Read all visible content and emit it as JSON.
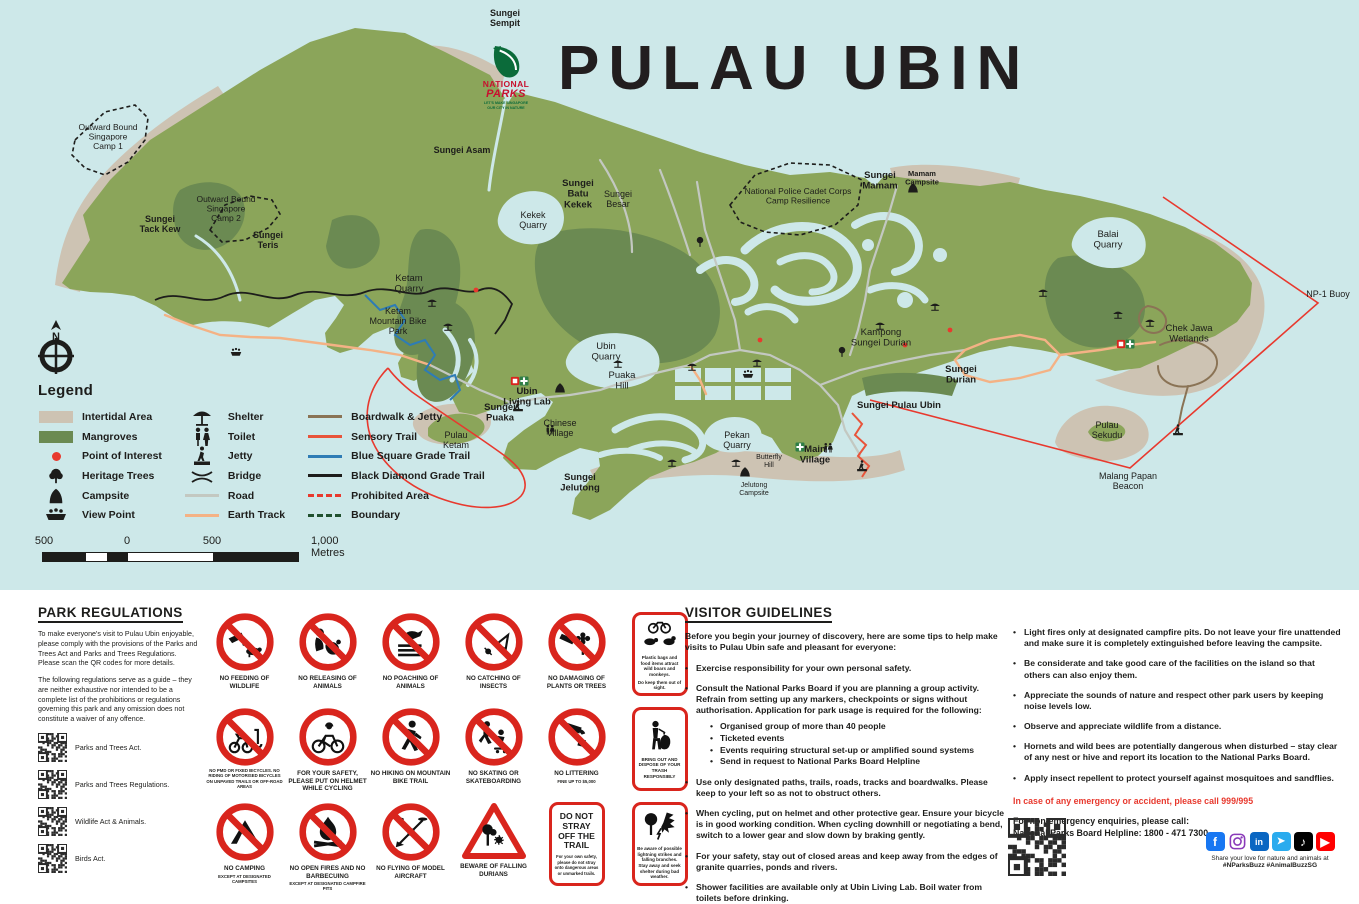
{
  "title": "PULAU UBIN",
  "logo": {
    "line1": "NATIONAL",
    "line2": "PARKS",
    "tagline1": "LET'S MAKE SINGAPORE",
    "tagline2": "OUR CITY IN NATURE"
  },
  "colors": {
    "water": "#cde8e9",
    "land": "#8ba55a",
    "mangrove": "#6b8a52",
    "intertidal": "#cdc3b3",
    "road": "#c3c8c1",
    "earth_track": "#f4b285",
    "boardwalk": "#8a7355",
    "blue_trail": "#2e7cb5",
    "red": "#e8392e",
    "sign_red": "#d9251d",
    "text": "#1d1d1b"
  },
  "map": {
    "compass_label": "N",
    "labels": [
      {
        "lines": [
          "Sungei",
          "Sempit"
        ],
        "x": 505,
        "y": 16,
        "bold": true,
        "size": 9
      },
      {
        "lines": [
          "Outward Bound",
          "Singapore",
          "Camp 1"
        ],
        "x": 108,
        "y": 130,
        "bold": false,
        "size": 8.5
      },
      {
        "lines": [
          "Outward Bound",
          "Singapore",
          "Camp 2"
        ],
        "x": 226,
        "y": 202,
        "bold": false,
        "size": 8.5
      },
      {
        "lines": [
          "Sungei",
          "Tack Kew"
        ],
        "x": 160,
        "y": 222,
        "bold": true,
        "size": 9
      },
      {
        "lines": [
          "Sungei",
          "Teris"
        ],
        "x": 268,
        "y": 238,
        "bold": true,
        "size": 9
      },
      {
        "lines": [
          "Sungei Asam"
        ],
        "x": 462,
        "y": 153,
        "bold": true,
        "size": 9
      },
      {
        "lines": [
          "Sungei",
          "Batu",
          "Kekek"
        ],
        "x": 578,
        "y": 186,
        "bold": true,
        "size": 9.5
      },
      {
        "lines": [
          "Sungei",
          "Besar"
        ],
        "x": 618,
        "y": 197,
        "bold": false,
        "size": 9
      },
      {
        "lines": [
          "Kekek",
          "Quarry"
        ],
        "x": 533,
        "y": 218,
        "bold": false,
        "size": 9
      },
      {
        "lines": [
          "Ketam",
          "Quarry"
        ],
        "x": 409,
        "y": 281,
        "bold": false,
        "size": 9.5
      },
      {
        "lines": [
          "Ketam",
          "Mountain Bike",
          "Park"
        ],
        "x": 398,
        "y": 314,
        "bold": false,
        "size": 9
      },
      {
        "lines": [
          "Ubin",
          "Quarry"
        ],
        "x": 606,
        "y": 349,
        "bold": false,
        "size": 9.5
      },
      {
        "lines": [
          "Puaka",
          "Hill"
        ],
        "x": 622,
        "y": 378,
        "bold": false,
        "size": 9.5
      },
      {
        "lines": [
          "Ubin",
          "Living Lab"
        ],
        "x": 527,
        "y": 394,
        "bold": true,
        "size": 9.5
      },
      {
        "lines": [
          "Sungei",
          "Puaka"
        ],
        "x": 500,
        "y": 410,
        "bold": true,
        "size": 9.5
      },
      {
        "lines": [
          "Chinese",
          "Village"
        ],
        "x": 560,
        "y": 426,
        "bold": false,
        "size": 9
      },
      {
        "lines": [
          "Pulau",
          "Ketam"
        ],
        "x": 456,
        "y": 438,
        "bold": false,
        "size": 9
      },
      {
        "lines": [
          "Sungei",
          "Jelutong"
        ],
        "x": 580,
        "y": 480,
        "bold": true,
        "size": 9.5
      },
      {
        "lines": [
          "Pekan",
          "Quarry"
        ],
        "x": 737,
        "y": 438,
        "bold": false,
        "size": 9
      },
      {
        "lines": [
          "Butterfly",
          "Hill"
        ],
        "x": 769,
        "y": 459,
        "bold": false,
        "size": 7
      },
      {
        "lines": [
          "Main",
          "Village"
        ],
        "x": 815,
        "y": 452,
        "bold": true,
        "size": 9.5
      },
      {
        "lines": [
          "Jelutong",
          "Campsite"
        ],
        "x": 754,
        "y": 487,
        "bold": false,
        "size": 7
      },
      {
        "lines": [
          "Sungei",
          "Mamam"
        ],
        "x": 880,
        "y": 178,
        "bold": true,
        "size": 9.5
      },
      {
        "lines": [
          "Mamam",
          "Campsite"
        ],
        "x": 922,
        "y": 176,
        "bold": true,
        "size": 7.5
      },
      {
        "lines": [
          "National Police Cadet Corps",
          "Camp Resilience"
        ],
        "x": 798,
        "y": 194,
        "bold": false,
        "size": 8.5
      },
      {
        "lines": [
          "Kampong",
          "Sungei Durian"
        ],
        "x": 881,
        "y": 335,
        "bold": false,
        "size": 9.5
      },
      {
        "lines": [
          "Sungei",
          "Durian"
        ],
        "x": 961,
        "y": 372,
        "bold": true,
        "size": 9.5
      },
      {
        "lines": [
          "Sungei Pulau Ubin"
        ],
        "x": 899,
        "y": 408,
        "bold": true,
        "size": 9.5
      },
      {
        "lines": [
          "Balai",
          "Quarry"
        ],
        "x": 1108,
        "y": 237,
        "bold": false,
        "size": 9.5
      },
      {
        "lines": [
          "Chek Jawa",
          "Wetlands"
        ],
        "x": 1189,
        "y": 331,
        "bold": false,
        "size": 9.5
      },
      {
        "lines": [
          "NP-1 Buoy"
        ],
        "x": 1328,
        "y": 297,
        "bold": false,
        "size": 9
      },
      {
        "lines": [
          "Pulau",
          "Sekudu"
        ],
        "x": 1107,
        "y": 428,
        "bold": false,
        "size": 9
      },
      {
        "lines": [
          "Malang Papan",
          "Beacon"
        ],
        "x": 1128,
        "y": 479,
        "bold": false,
        "size": 9
      }
    ],
    "icons": [
      {
        "icon": "shelter-icon",
        "x": 432,
        "y": 302
      },
      {
        "icon": "shelter-icon",
        "x": 448,
        "y": 326
      },
      {
        "icon": "shelter-icon",
        "x": 618,
        "y": 363
      },
      {
        "icon": "shelter-icon",
        "x": 692,
        "y": 366
      },
      {
        "icon": "shelter-icon",
        "x": 757,
        "y": 362
      },
      {
        "icon": "shelter-icon",
        "x": 880,
        "y": 325
      },
      {
        "icon": "shelter-icon",
        "x": 935,
        "y": 306
      },
      {
        "icon": "shelter-icon",
        "x": 1043,
        "y": 292
      },
      {
        "icon": "shelter-icon",
        "x": 1118,
        "y": 314
      },
      {
        "icon": "shelter-icon",
        "x": 1150,
        "y": 322
      },
      {
        "icon": "shelter-icon",
        "x": 736,
        "y": 462
      },
      {
        "icon": "shelter-icon",
        "x": 672,
        "y": 462
      },
      {
        "icon": "toilet-icon",
        "x": 550,
        "y": 430
      },
      {
        "icon": "toilet-icon",
        "x": 828,
        "y": 448
      },
      {
        "icon": "jetty-icon",
        "x": 862,
        "y": 466
      },
      {
        "icon": "jetty-icon",
        "x": 1178,
        "y": 430
      },
      {
        "icon": "jetty-icon",
        "x": 518,
        "y": 406
      },
      {
        "icon": "green-cross-icon",
        "x": 524,
        "y": 381
      },
      {
        "icon": "green-cross-icon",
        "x": 800,
        "y": 447
      },
      {
        "icon": "green-cross-icon",
        "x": 1130,
        "y": 344
      },
      {
        "icon": "red-square-icon",
        "x": 515,
        "y": 381
      },
      {
        "icon": "red-square-icon",
        "x": 1121,
        "y": 344
      },
      {
        "icon": "viewpoint-icon",
        "x": 236,
        "y": 352
      },
      {
        "icon": "viewpoint-icon",
        "x": 748,
        "y": 374
      },
      {
        "icon": "campsite-icon",
        "x": 560,
        "y": 388
      },
      {
        "icon": "campsite-icon",
        "x": 913,
        "y": 188
      },
      {
        "icon": "campsite-icon",
        "x": 745,
        "y": 472
      },
      {
        "icon": "tree-icon",
        "x": 842,
        "y": 352
      },
      {
        "icon": "tree-icon",
        "x": 700,
        "y": 242
      },
      {
        "icon": "poi-dot",
        "x": 760,
        "y": 340
      },
      {
        "icon": "poi-dot",
        "x": 950,
        "y": 330
      },
      {
        "icon": "poi-dot",
        "x": 905,
        "y": 345
      },
      {
        "icon": "poi-dot",
        "x": 476,
        "y": 290
      }
    ]
  },
  "legend": {
    "title": "Legend",
    "columns": [
      [
        {
          "label": "Intertidal Area",
          "kind": "block",
          "color": "#cdc3b3",
          "name": "intertidal-swatch"
        },
        {
          "label": "Mangroves",
          "kind": "block",
          "color": "#6b8a52",
          "name": "mangroves-swatch"
        },
        {
          "label": "Point of Interest",
          "kind": "dot",
          "color": "#e8392e",
          "name": "point-of-interest-icon"
        },
        {
          "label": "Heritage Trees",
          "kind": "icon",
          "icon": "tree",
          "name": "heritage-tree-icon"
        },
        {
          "label": "Campsite",
          "kind": "icon",
          "icon": "campsite",
          "name": "campsite-icon"
        },
        {
          "label": "View Point",
          "kind": "icon",
          "icon": "viewpoint",
          "name": "viewpoint-icon"
        }
      ],
      [
        {
          "label": "Shelter",
          "kind": "icon",
          "icon": "shelter",
          "name": "shelter-icon"
        },
        {
          "label": "Toilet",
          "kind": "icon",
          "icon": "toilet",
          "name": "toilet-icon"
        },
        {
          "label": "Jetty",
          "kind": "icon",
          "icon": "jetty",
          "name": "jetty-icon"
        },
        {
          "label": "Bridge",
          "kind": "icon",
          "icon": "bridge",
          "name": "bridge-icon"
        },
        {
          "label": "Road",
          "kind": "line",
          "color": "#c3c8c1",
          "dash": "",
          "name": "road-line"
        },
        {
          "label": "Earth Track",
          "kind": "line",
          "color": "#f4b285",
          "dash": "",
          "name": "earth-track-line"
        }
      ],
      [
        {
          "label": "Boardwalk & Jetty",
          "kind": "line",
          "color": "#8a7355",
          "dash": "",
          "name": "boardwalk-line"
        },
        {
          "label": "Sensory Trail",
          "kind": "line",
          "color": "#e8543a",
          "dash": "",
          "name": "sensory-trail-line"
        },
        {
          "label": "Blue Square Grade Trail",
          "kind": "line",
          "color": "#2e7cb5",
          "dash": "",
          "name": "blue-square-trail-line"
        },
        {
          "label": "Black Diamond Grade Trail",
          "kind": "line",
          "color": "#1d1d1b",
          "dash": "",
          "name": "black-diamond-trail-line"
        },
        {
          "label": "Prohibited Area",
          "kind": "line",
          "color": "#e8392e",
          "dash": "dash",
          "name": "prohibited-area-line"
        },
        {
          "label": "Boundary",
          "kind": "line",
          "color": "#20512f",
          "dash": "dash",
          "name": "boundary-line"
        }
      ]
    ]
  },
  "scalebar": {
    "labels": [
      "500",
      "0",
      "500",
      "1,000 Metres"
    ]
  },
  "regulations": {
    "title": "PARK REGULATIONS",
    "para1": "To make everyone's visit to Pulau Ubin enjoyable, please comply with the provisions of the Parks and Trees Act and Parks and Trees Regulations. Please scan the QR codes for more details.",
    "para2": "The following regulations serve as a guide – they are neither exhaustive nor intended to be a complete list of the prohibitions or regulations governing this park and any omission does not constitute a waiver of any offence.",
    "qr_items": [
      "Parks and Trees Act.",
      "Parks and Trees Regulations.",
      "Wildlife Act & Animals.",
      "Birds Act."
    ]
  },
  "signs": {
    "rows": [
      [
        {
          "type": "circle",
          "slash": true,
          "icon": "feeding",
          "name": "no-feeding-of-wildlife-sign",
          "label": "NO FEEDING OF WILDLIFE"
        },
        {
          "type": "circle",
          "slash": true,
          "icon": "release",
          "name": "no-releasing-of-animals-sign",
          "label": "NO RELEASING OF ANIMALS"
        },
        {
          "type": "circle",
          "slash": true,
          "icon": "poach",
          "name": "no-poaching-of-animals-sign",
          "label": "NO POACHING OF ANIMALS"
        },
        {
          "type": "circle",
          "slash": true,
          "icon": "catch",
          "name": "no-catching-of-insects-sign",
          "label": "NO CATCHING OF INSECTS"
        },
        {
          "type": "circle",
          "slash": true,
          "icon": "damage",
          "name": "no-damaging-plants-sign",
          "label": "NO DAMAGING OF PLANTS OR TREES"
        },
        {
          "type": "redbox",
          "icon": "boar-monkey",
          "name": "wildlife-food-advice-sign",
          "text": "Plastic bags and food items attract wild boars and monkeys.",
          "text2": "Do keep them out of sight."
        }
      ],
      [
        {
          "type": "circle",
          "slash": true,
          "icon": "pmd",
          "name": "no-pmd-sign",
          "sub": "NO PMD OR FIXED BICYCLES. NO RIDING OF MOTORISED BICYCLES ON UNPAVED TRAILS OR OFF-ROAD AREAS"
        },
        {
          "type": "circle",
          "slash": false,
          "icon": "cyclist",
          "name": "helmet-advice-sign",
          "label": "FOR YOUR SAFETY, PLEASE PUT ON HELMET WHILE CYCLING"
        },
        {
          "type": "circle",
          "slash": true,
          "icon": "hiker",
          "name": "no-hiking-sign",
          "label": "NO HIKING ON MOUNTAIN BIKE TRAIL"
        },
        {
          "type": "circle",
          "slash": true,
          "icon": "skater",
          "name": "no-skating-sign",
          "label": "NO SKATING OR SKATEBOARDING"
        },
        {
          "type": "circle",
          "slash": true,
          "icon": "litter",
          "name": "no-littering-sign",
          "label": "NO LITTERING",
          "sub": "FINE UP TO $5,000"
        },
        {
          "type": "redbox",
          "icon": "trash-person",
          "name": "dispose-trash-advice-sign",
          "text": "BRING OUT AND DISPOSE OF YOUR TRASH RESPONSIBLY"
        }
      ],
      [
        {
          "type": "circle",
          "slash": true,
          "icon": "tent",
          "name": "no-camping-sign",
          "label": "NO CAMPING",
          "sub": "EXCEPT AT DESIGNATED CAMPSITES"
        },
        {
          "type": "circle",
          "slash": true,
          "icon": "fire",
          "name": "no-open-fires-sign",
          "label": "NO OPEN FIRES AND NO BARBECUING",
          "sub": "EXCEPT AT DESIGNATED CAMPFIRE PITS"
        },
        {
          "type": "circle",
          "slash": true,
          "icon": "drone",
          "name": "no-model-aircraft-sign",
          "label": "NO FLYING OF MODEL AIRCRAFT"
        },
        {
          "type": "triangle",
          "icon": "durian",
          "name": "falling-durians-warning-sign",
          "label": "BEWARE OF FALLING DURIANS"
        },
        {
          "type": "textbox",
          "name": "do-not-stray-sign",
          "text": "DO NOT STRAY OFF THE TRAIL",
          "sub": "For your own safety, please do not stray onto dangerous areas or unmarked trails."
        },
        {
          "type": "redbox",
          "icon": "lightning-trees",
          "name": "lightning-advice-sign",
          "text": "Be aware of possible lightning strikes and falling branches. Stay away and seek shelter during bad weather."
        }
      ]
    ]
  },
  "guidelines": {
    "title": "VISITOR GUIDELINES",
    "intro": "Before you begin your journey of discovery, here are some tips to help make visits to Pulau Ubin safe and pleasant for everyone:",
    "col1": [
      {
        "text": "Exercise responsibility for your own personal safety."
      },
      {
        "text": "Consult the National Parks Board if you are planning a group activity. Refrain from setting up any markers, checkpoints or signs without authorisation. Application for park usage is required for the following:",
        "subs": [
          "Organised group of more than 40 people",
          "Ticketed events",
          "Events requiring structural set-up or amplified sound systems",
          "Send in request to National Parks Board Helpline"
        ]
      },
      {
        "text": "Use only designated paths, trails, roads, tracks and boardwalks. Please keep to your left so as not to obstruct others."
      },
      {
        "text": "When cycling, put on helmet and other protective gear. Ensure your bicycle is in good working condition. When cycling downhill or negotiating a bend, switch to a lower gear and slow down by braking gently."
      },
      {
        "text": "For your safety, stay out of closed areas and keep away from the edges of granite quarries, ponds and rivers."
      },
      {
        "text": "Shower facilities are available only at Ubin Living Lab. Boil water from toilets before drinking."
      }
    ],
    "col2": [
      {
        "text": "Light fires only at designated campfire pits. Do not leave your fire unattended and make sure it is completely extinguished before leaving the campsite."
      },
      {
        "text": "Be considerate and take good care of the facilities on the island so that others can also enjoy them."
      },
      {
        "text": "Appreciate the sounds of nature and respect other park users by keeping noise levels low."
      },
      {
        "text": "Observe and appreciate wildlife from a distance."
      },
      {
        "text": "Hornets and wild bees are potentially dangerous when disturbed – stay clear of any nest or hive and report its location to the National Parks Board."
      },
      {
        "text": "Apply insect repellent to protect yourself against mosquitoes and sandflies."
      }
    ],
    "emergency": "In case of any emergency or accident, please call 999/995",
    "nonemergency1": "For non-emergency enquiries, please call:",
    "nonemergency2": "National Parks Board Helpline: 1800 - 471 7300",
    "social_caption1": "Share your love for nature and animals at",
    "social_caption2": "#NParksBuzz #AnimalBuzzSG",
    "social_icons": [
      "facebook",
      "instagram",
      "linkedin",
      "telegram",
      "tiktok",
      "youtube"
    ]
  }
}
